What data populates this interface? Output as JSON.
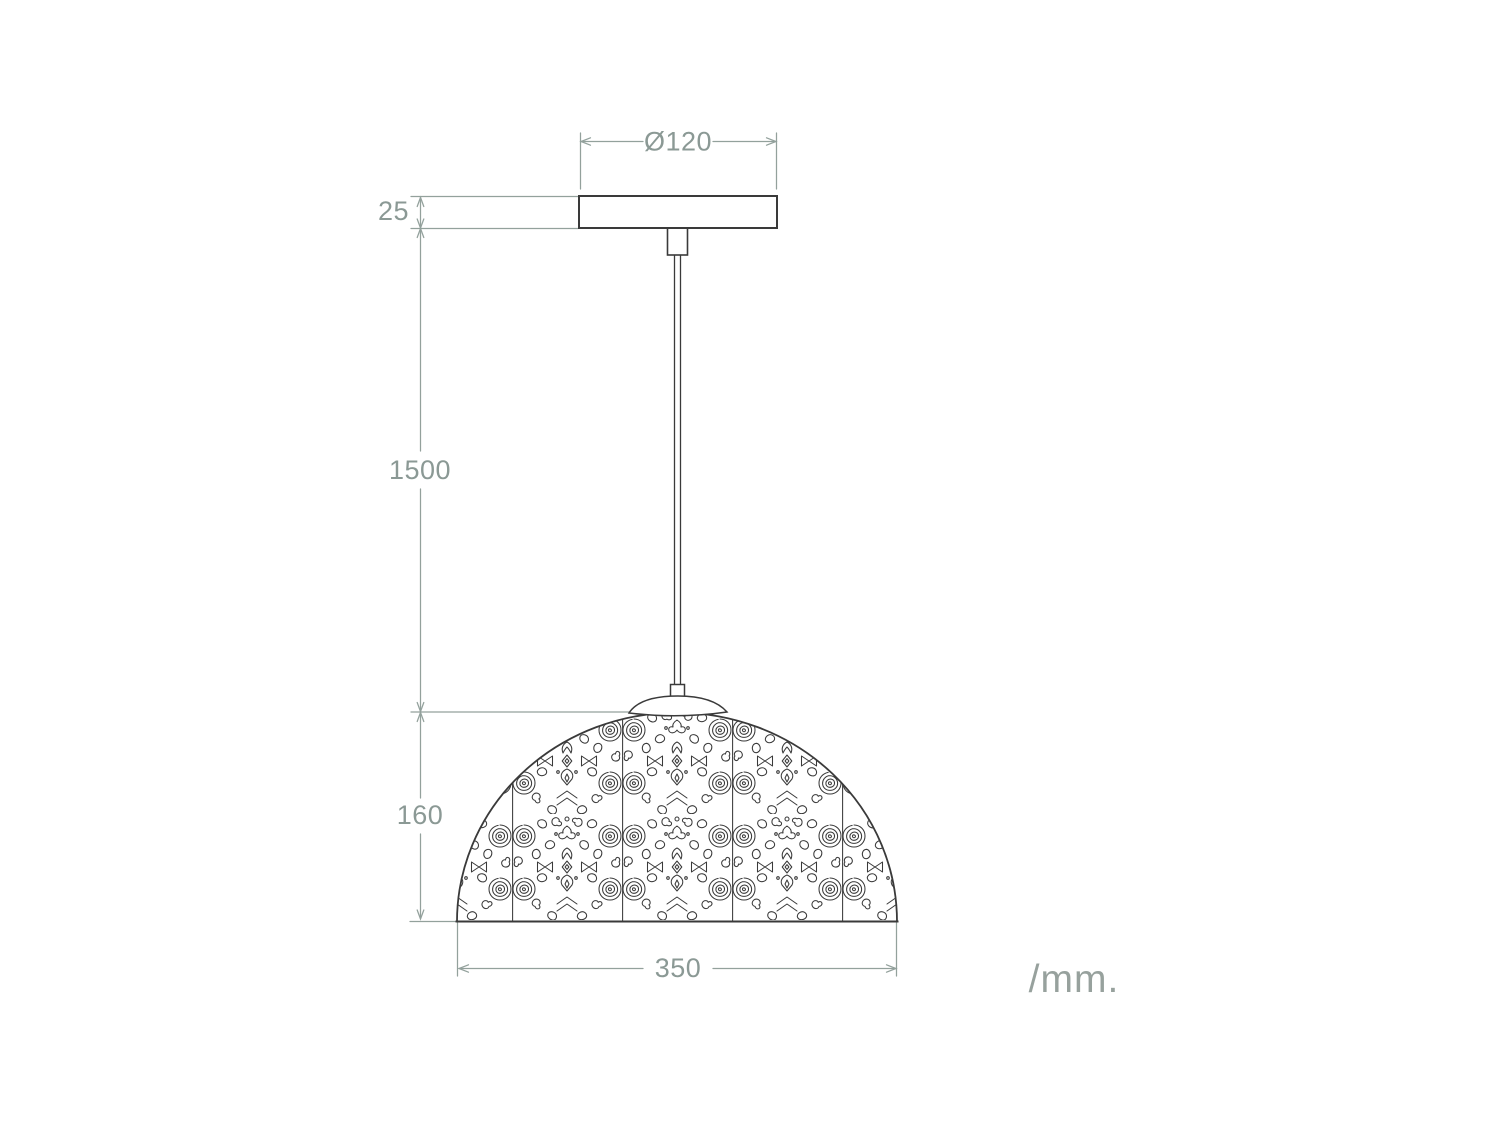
{
  "diagram": {
    "type": "technical-dimension-drawing",
    "subject": "pendant-lamp",
    "units_label": "/mm.",
    "dimensions": {
      "canopy_diameter": "Ø120",
      "canopy_height": "25",
      "cable_length": "1500",
      "shade_height": "160",
      "shade_diameter": "350"
    },
    "colors": {
      "outline": "#3a3a3a",
      "dimension": "#93a19c",
      "dim_text": "#8b9995",
      "units_text": "#97a19d",
      "background": "#ffffff"
    }
  }
}
